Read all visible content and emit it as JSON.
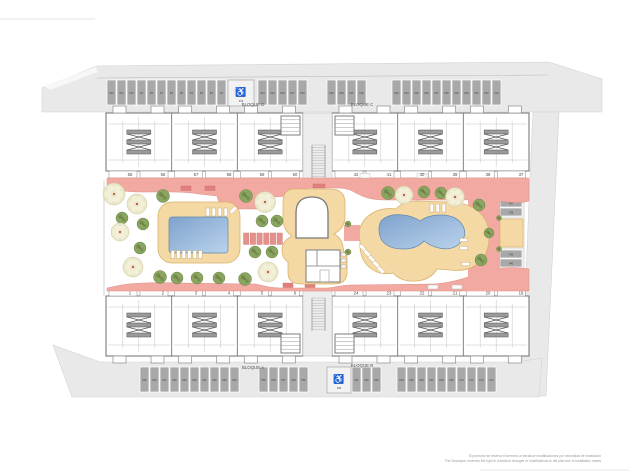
{
  "plan": {
    "type": "residential-site-plan",
    "blocks": [
      {
        "id": "D",
        "label": "BLOQUE D",
        "units": [
          "55",
          "56",
          "57",
          "58",
          "59",
          "60"
        ]
      },
      {
        "id": "C",
        "label": "BLOQUE C",
        "units": [
          "42",
          "41",
          "40",
          "39",
          "38",
          "37"
        ]
      },
      {
        "id": "A",
        "label": "BLOQUE A",
        "units": [
          "1",
          "2",
          "3",
          "4",
          "5",
          "6"
        ]
      },
      {
        "id": "B",
        "label": "BLOQUE B",
        "units": [
          "24",
          "23",
          "22",
          "21",
          "20",
          "19"
        ]
      }
    ],
    "parking": {
      "accessible_symbol": "♿",
      "groups": [
        {
          "id": "top-left",
          "labels": [
            "P12",
            "P11",
            "P10",
            "P9",
            "P8",
            "P7",
            "P6",
            "P5",
            "P4",
            "P3",
            "P2",
            "P1"
          ]
        },
        {
          "id": "top-mid",
          "labels": [
            "P14",
            "P15",
            "P16",
            "P17",
            "P18"
          ]
        },
        {
          "id": "top-center",
          "labels": [
            "P19",
            "P20",
            "P21",
            "P22"
          ]
        },
        {
          "id": "top-right",
          "labels": [
            "P23",
            "P24",
            "P25",
            "P26",
            "P27",
            "P28",
            "P29",
            "P30",
            "P31",
            "P32",
            "P33"
          ]
        },
        {
          "id": "right-upper",
          "labels": [
            "P34",
            "P35",
            "P36",
            "P37",
            "P38"
          ]
        },
        {
          "id": "right-lower",
          "labels": [
            "P39",
            "P40",
            "P41",
            "P42",
            "P43",
            "P44"
          ]
        },
        {
          "id": "bottom-left",
          "labels": [
            "P45",
            "P46",
            "P47",
            "P48",
            "P49",
            "P50",
            "P51",
            "P52",
            "P53",
            "P54"
          ]
        },
        {
          "id": "bottom-mid",
          "labels": [
            "P55",
            "P56",
            "P57",
            "P58",
            "P59"
          ]
        },
        {
          "id": "bottom-b",
          "labels": [
            "P61",
            "P62",
            "P63"
          ]
        },
        {
          "id": "bottom-right",
          "labels": [
            "P64",
            "P65",
            "P66",
            "P67",
            "P68",
            "P69",
            "P70",
            "P71",
            "P72",
            "P73"
          ]
        }
      ],
      "accessible": [
        {
          "id": "top-left-accessible",
          "label": "P13"
        },
        {
          "id": "bottom-b-accessible",
          "label": "P60"
        }
      ]
    },
    "colors": {
      "walkway": "#f2a9a1",
      "deck": "#f4d9a5",
      "pool_dark": "#7fa2cc",
      "pool_light": "#b9d3ec",
      "street": "#e9e9e9",
      "parking": "#a8a8a8",
      "tree_green": "#89a55f",
      "tree_cream": "#eae6c8",
      "planter": "#e4918c",
      "wall": "#6e6e6e"
    },
    "disclaimer": {
      "line1_es": "El promotor se reserva el derecho a introducir modificaciones por necesidad de instalación",
      "line2_en": "The Developer reserves the right to introduce changes or modifications to the plan due to installation needs"
    }
  }
}
